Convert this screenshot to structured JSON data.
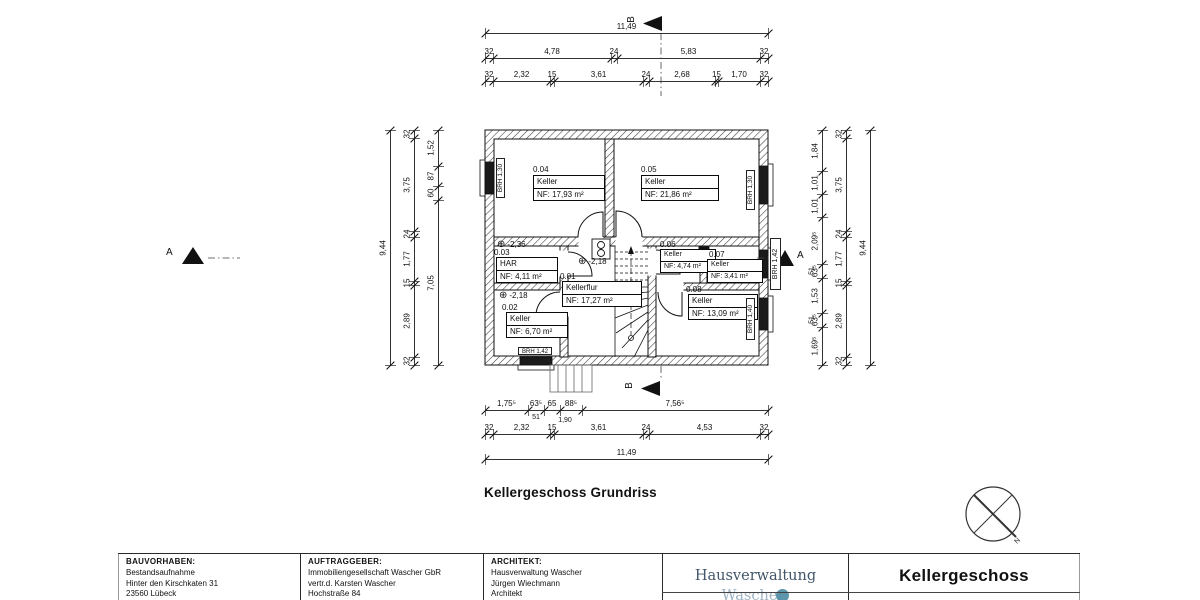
{
  "plan": {
    "caption": "Kellergeschoss Grundriss",
    "north_label": "N",
    "section_labels": {
      "a": "A",
      "b": "B"
    },
    "rooms": [
      {
        "number": "0.04",
        "name": "Keller",
        "area": "NF: 17,93 m²"
      },
      {
        "number": "0.05",
        "name": "Keller",
        "area": "NF: 21,86 m²"
      },
      {
        "number": "0.03",
        "name": "HAR",
        "area": "NF: 4,11 m²"
      },
      {
        "number": "0.01",
        "name": "Kellerflur",
        "area": "NF: 17,27 m²"
      },
      {
        "number": "0.02",
        "name": "Keller",
        "area": "NF: 6,70 m²"
      },
      {
        "number": "0.06",
        "name": "Keller",
        "area": "NF: 4,74 m²"
      },
      {
        "number": "0.07",
        "name": "Keller",
        "area": "NF: 3,41 m²"
      },
      {
        "number": "0.08",
        "name": "Keller",
        "area": "NF: 13,09 m²"
      }
    ],
    "level_markers": [
      {
        "value": "-2,36"
      },
      {
        "value": "-2,18"
      },
      {
        "value": "-2,18"
      }
    ],
    "window_labels": [
      {
        "text": "BRH 1,30"
      },
      {
        "text": "BRH 1,30"
      },
      {
        "text": "BRH 1,42"
      },
      {
        "text": "BRH 1,40"
      },
      {
        "text": "BRH 1,42"
      }
    ],
    "dimensions": {
      "top": {
        "row1": [
          "11,49"
        ],
        "row2": [
          "32",
          "4,78",
          "24",
          "5,83",
          "32"
        ],
        "row3": [
          "32",
          "2,32",
          "15",
          "3,61",
          "24",
          "2,68",
          "15",
          "1,70",
          "32"
        ]
      },
      "bottom": {
        "row1": [
          "1,75⁵",
          "63⁵",
          "65",
          "88⁵",
          "7,56⁵"
        ],
        "row1_sub": [
          "51",
          "1,90"
        ],
        "row2": [
          "32",
          "2,32",
          "15",
          "3,61",
          "24",
          "4,53",
          "32"
        ],
        "row3": [
          "11,49"
        ]
      },
      "left": {
        "outer": [
          "9,44"
        ],
        "middle": [
          "32",
          "3,75",
          "24",
          "1,77",
          "15",
          "2,89",
          "32"
        ],
        "inner": [
          "1,52",
          "87",
          "60",
          "7,05"
        ]
      },
      "right": {
        "outer": [
          "9,44"
        ],
        "middle": [
          "32",
          "3,75",
          "24",
          "1,77",
          "15",
          "2,89",
          "32"
        ],
        "inner": [
          "1,84",
          "1,01",
          "1,01",
          "2,09⁵",
          "63⁵",
          "1,53",
          "63⁵",
          "1,69⁵"
        ],
        "inner_sub": [
          "51",
          "51"
        ]
      }
    }
  },
  "title_block": {
    "bauvorhaben": {
      "label": "BAUVORHABEN:",
      "lines": [
        "Bestandsaufnahme",
        "Hinter den Kirschkaten 31",
        "23560 Lübeck"
      ]
    },
    "auftraggeber": {
      "label": "AUFTRAGGEBER:",
      "lines": [
        "Immobiliengesellschaft Wascher GbR",
        "vertr.d. Karsten Wascher",
        "Hochstraße 84"
      ]
    },
    "architekt": {
      "label": "ARCHITEKT:",
      "lines": [
        "Hausverwaltung Wascher",
        "Jürgen Wiechmann",
        "Architekt"
      ]
    },
    "logo": {
      "text_primary": "Hausverwaltung",
      "text_secondary": "Wascher",
      "primary_color": "#42566a",
      "secondary_color": "#9fb3c2",
      "circle_color": "#4c8ca3"
    },
    "sheet_title": "Kellergeschoss"
  }
}
